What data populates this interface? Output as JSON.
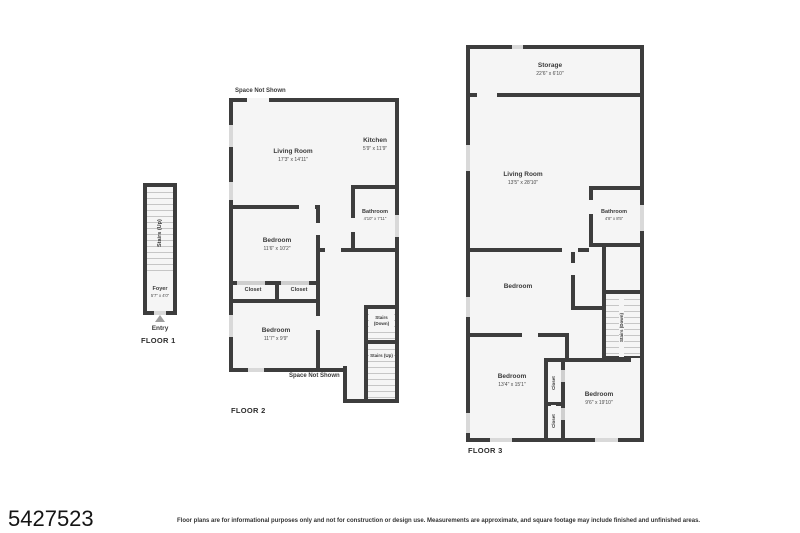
{
  "colors": {
    "wall": "#3d3d3d",
    "floor": "#f5f5f5",
    "window": "#d9d9d9",
    "text": "#3a3a3a"
  },
  "floor1": {
    "label": "FLOOR 1",
    "entry_label": "Entry",
    "rooms": {
      "stairs_up": {
        "name": "Stairs (Up)"
      },
      "foyer": {
        "name": "Foyer",
        "dims": "5'7\" x 4'0\""
      }
    }
  },
  "floor2": {
    "label": "FLOOR 2",
    "space_not_shown_top": "Space Not Shown",
    "space_not_shown_bottom": "Space Not Shown",
    "rooms": {
      "living": {
        "name": "Living Room",
        "dims": "17'3\" x 14'11\""
      },
      "kitchen": {
        "name": "Kitchen",
        "dims": "5'9\" x 11'9\""
      },
      "bathroom": {
        "name": "Bathroom",
        "dims": "4'10\" x 7'11\""
      },
      "bedroom_mid": {
        "name": "Bedroom",
        "dims": "11'6\" x 10'2\""
      },
      "closet_left": {
        "name": "Closet"
      },
      "closet_right": {
        "name": "Closet"
      },
      "bedroom_bottom": {
        "name": "Bedroom",
        "dims": "11'7\" x 9'9\""
      },
      "stairs_down": {
        "name": "Stairs (Down)"
      },
      "stairs_up": {
        "name": "Stairs (Up)"
      }
    }
  },
  "floor3": {
    "label": "FLOOR 3",
    "rooms": {
      "storage": {
        "name": "Storage",
        "dims": "22'6\" x 6'10\""
      },
      "living": {
        "name": "Living Room",
        "dims": "13'5\" x 28'10\""
      },
      "bathroom": {
        "name": "Bathroom",
        "dims": "4'8\" x 8'5\""
      },
      "bedroom_mid": {
        "name": "Bedroom"
      },
      "stairs_down": {
        "name": "Stairs (Down)"
      },
      "bedroom_left": {
        "name": "Bedroom",
        "dims": "13'4\" x 15'1\""
      },
      "closet_top": {
        "name": "Closet"
      },
      "closet_bottom": {
        "name": "Closet"
      },
      "bedroom_right": {
        "name": "Bedroom",
        "dims": "9'6\" x 19'10\""
      }
    }
  },
  "footer": {
    "listing_id": "5427523",
    "disclaimer": "Floor plans are for informational purposes only and not for construction or design use. Measurements are approximate, and square footage may include finished and unfinished areas."
  }
}
